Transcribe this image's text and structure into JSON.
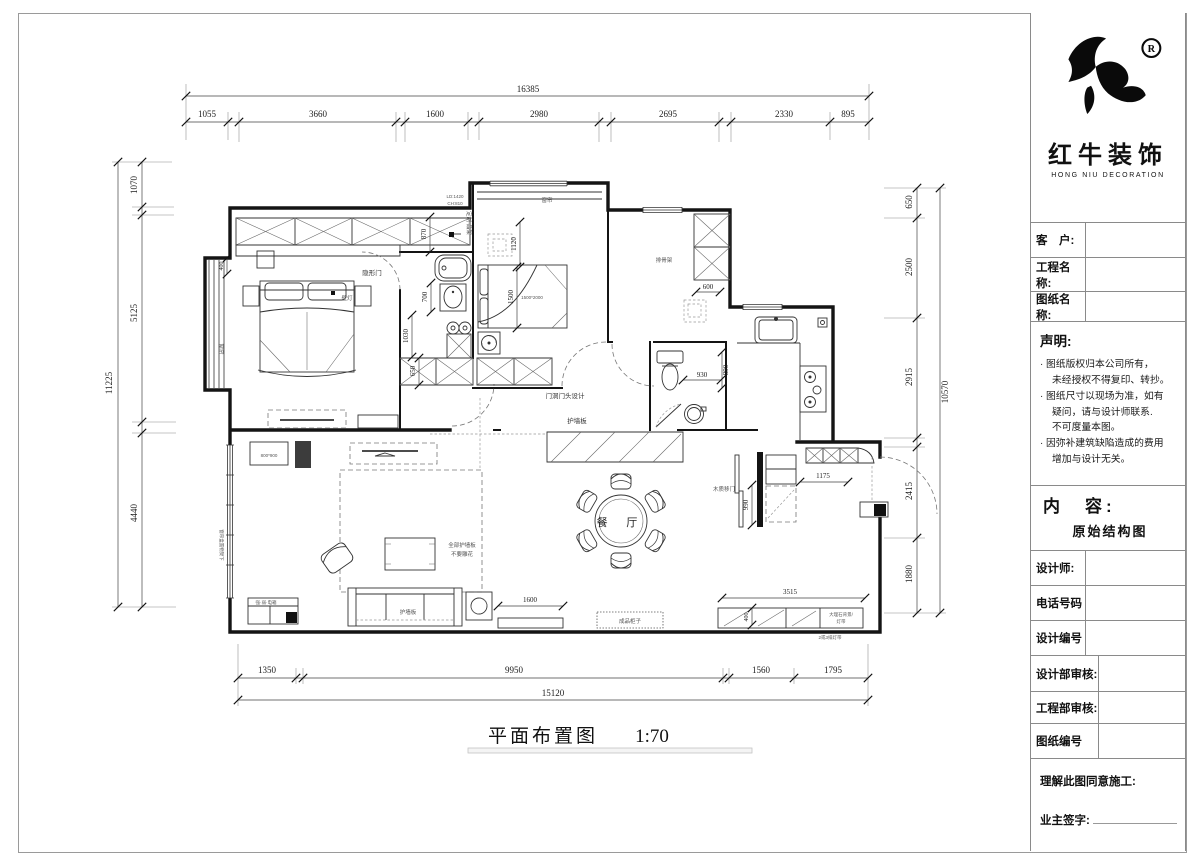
{
  "sheet": {
    "title": "平面布置图",
    "scale": "1:70"
  },
  "brand": {
    "name": "红牛装饰",
    "name_en": "HONG NIU DECORATION",
    "reg": "R"
  },
  "titleblock": {
    "customer_label": "客　户:",
    "project_label": "工程名称:",
    "drawing_label": "图纸名称:",
    "statement_title": "声明:",
    "statement_lines": [
      "· 图纸版权归本公司所有，",
      "未经授权不得复印、转抄。",
      "· 图纸尺寸以现场为准，如有",
      "疑问，请与设计师联系.",
      "不可度量本图。",
      "· 因弥补建筑缺陷造成的费用",
      "增加与设计无关。"
    ],
    "content_label": "内　容:",
    "content_value": "原始结构图",
    "designer_label": "设计师:",
    "phone_label": "电话号码",
    "design_no_label": "设计编号",
    "design_review_label": "设计部审核:",
    "eng_review_label": "工程部审核:",
    "drawing_no_label": "图纸编号",
    "agree_label": "理解此图同意施工:",
    "owner_sign_label": "业主签字:"
  },
  "dims": {
    "top_total": "16385",
    "top": [
      "1055",
      "3660",
      "1600",
      "2980",
      "2695",
      "2330",
      "895"
    ],
    "left_total": "11225",
    "left": [
      "1070",
      "5125",
      "4440"
    ],
    "right_total": "10570",
    "right": [
      "650",
      "2500",
      "2915",
      "2415",
      "1880"
    ],
    "bottom_total": "15120",
    "bottom": [
      "1350",
      "9950",
      "1560",
      "1795"
    ],
    "inner": {
      "d870": "870",
      "d1120": "1120",
      "d700": "700",
      "d1030": "1030",
      "d650": "650",
      "d400a": "400",
      "d1500": "1500",
      "d600": "600",
      "d930": "930",
      "d890": "890",
      "d1175": "1175",
      "d990": "990",
      "d3515": "3515",
      "d400b": "400",
      "d1600": "1600"
    }
  },
  "labels": {
    "dining": "餐 厅",
    "hidden_door": "隐形门",
    "wall_lamp": "壁灯",
    "curtain": "窗帘",
    "custom_rack": "定制·品架",
    "ld": "LD:1420",
    "ch": "CH:810",
    "bed_size": "1500*2000",
    "slat_frame": "排骨架",
    "door_head": "门洞门头设计",
    "wall_panel": "护墙板",
    "wood_slide_door": "木质移门",
    "marble_line1": "大理石背景/",
    "marble_line2": "灯带",
    "lights_note": "2或3排灯带",
    "finished_cabinet": "成品柜子",
    "panel_note1": "全部护墙板",
    "panel_note2": "不要雕花",
    "niche_size": "800*900",
    "curtain_box": "窗帘盒置物架下",
    "elec_box": "强·弱·电箱"
  }
}
